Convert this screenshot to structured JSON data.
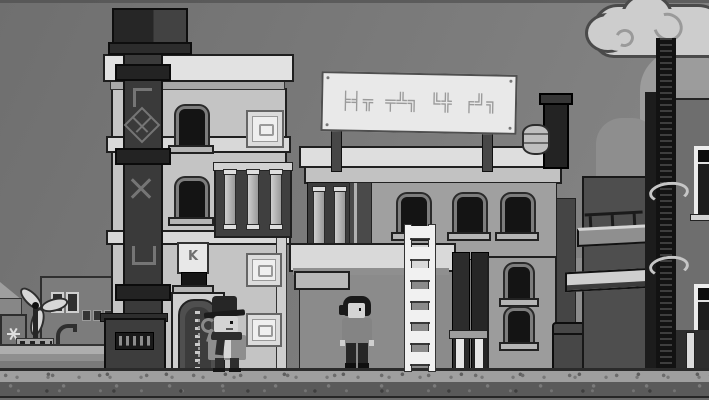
{
  "app": {
    "type": "monochrome pixel-art adventure game scene",
    "visible_text": "none (signage uses fictional glyphs)"
  },
  "sign": {
    "glyphs": "╞╡╦ ╤╩╗ ╚╬ ╒╝╗"
  },
  "labels": {
    "shutter_mark": "K"
  },
  "scene_objects": {
    "left_building": "light tenement with dark exhaust pipe, arched windows, plaques, zipper-pattern door",
    "pipe_symbols": "bracket, diamond-cross, X, U-bracket glyphs on pipe",
    "middle_building": "sided building with glyph billboard, colonnade, three arched windows, barrel and chimney on roof",
    "right_building": "dark high-rise with caged service pipe, hooped conduit, white framed windows, awnings",
    "background": "windmill turbine, low district buildings, lamp post, cooler box with star symbol, gabled roof",
    "characters": {
      "npc": "man with dark fedora, scarf and wrench standing by door",
      "player": "dark-haired character in grey t-shirt standing by ladder"
    },
    "props": [
      "white ladder",
      "barrel",
      "dumpster",
      "clouds with swirls"
    ]
  },
  "palette": {
    "sky_top": "#6f6f6f",
    "sky_bottom": "#878787",
    "outline": "#1f1f1f",
    "cloud_fill": "#cdcdcd",
    "cloud_outline": "#4a4a4a",
    "cloud_soft": "#9c9c9c",
    "bldg_left_wall": "#c4c4c4",
    "bldg_left_trim": "#e2e2e2",
    "pipe_dark": "#3a3a3a",
    "pipe_joint": "#232323",
    "pipe_symbol": "#757575",
    "window_pane": "#141414",
    "window_frame": "#7d7d7d",
    "sill": "#b5b5b5",
    "door_fill": "#4f4f4f",
    "door_frame": "#cfcfcf",
    "mid_wall_upper": "#a0a0a0",
    "mid_wall_lower": "#8b8b8b",
    "mid_roof": "#dedede",
    "awning": "#d9d9d9",
    "sign_bg": "#e9e9e9",
    "sign_border": "#4f4f4f",
    "sign_glyph": "#9a9a9a",
    "right_wall": "#6e6e6e",
    "right_wing": "#4e4e4e",
    "right_pipe": "#121212",
    "hoop": "#c6c6c6",
    "ground_band": "#9f9f9f",
    "ground_body": "#5a5a5a",
    "ground_dark": "#262626",
    "ground_bottom": "#6a6a6a",
    "char_skin": "#d4d4d4",
    "npc_coat": "#8e8e8e",
    "player_shirt": "#848484",
    "ladder": "#f1f1f1",
    "bg_bldg": "#7c7c7c",
    "blade": "#d7d7d7"
  }
}
